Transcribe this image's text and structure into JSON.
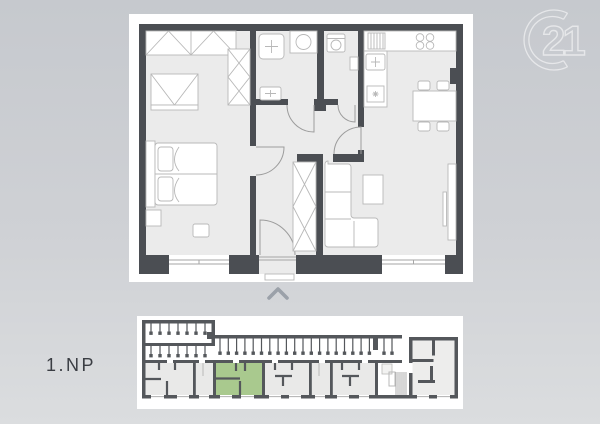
{
  "overview": {
    "floor_label": "1.NP"
  },
  "watermark": {
    "brand_number": "21"
  },
  "unit_plan": {
    "rooms": [
      "bedroom",
      "bathroom",
      "wc",
      "hallway",
      "kitchen-dining",
      "living-room"
    ]
  },
  "colors": {
    "bg_top": "#c6c9ce",
    "bg_bottom": "#dbdddf",
    "card": "#ffffff",
    "wall": "#4b4e53",
    "bwall": "#54575b",
    "floor": "#ebebeb",
    "furn": "#b8b8b8",
    "door": "#9c9c9c",
    "win": "#a6a6a6",
    "green": "#a9c98e",
    "ufloor": "#e9e9e8",
    "rfloor": "#ededec",
    "binner": "#b9b9b9",
    "chevron": "#9ba1a9",
    "label": "#3a3d43",
    "logo": "rgba(255,255,255,0.55)"
  }
}
